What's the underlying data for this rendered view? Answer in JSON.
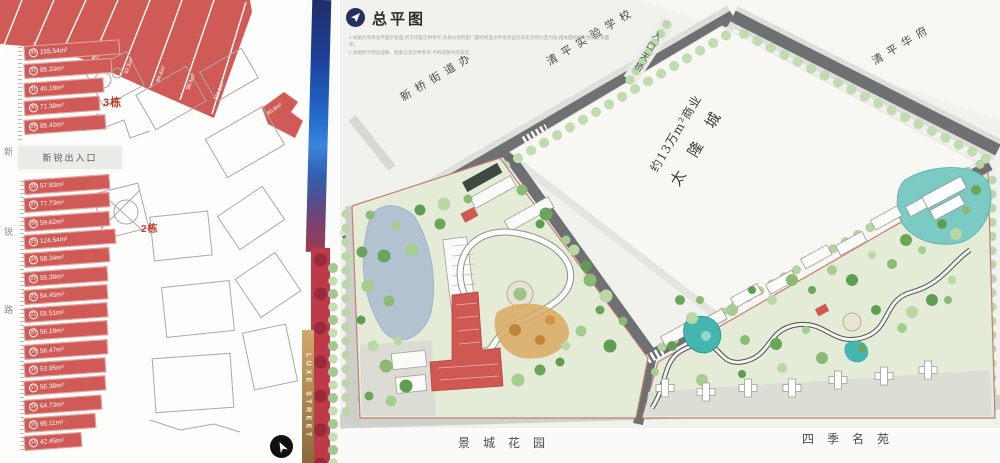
{
  "header": {
    "title": "总平图",
    "disclaimer_line1": "1.本图为项目总平面示意图,所示内容仅供参考,具体以政府部门最终批准文件及商品房买卖合同约定为准;相关面积均为预测建筑面积。",
    "disclaimer_line2": "2.本图所示周边道路、配套信息仅供参考,不构成要约或承诺。"
  },
  "floorplan": {
    "building3_label": "3栋",
    "building2_label": "2栋",
    "entrance_label": "新锐出入口",
    "street_chars": [
      "新",
      "锐",
      "路"
    ],
    "diagonal_units": [
      {
        "no": "1",
        "area": "96.4m²"
      },
      {
        "no": "2",
        "area": "88.3m²"
      },
      {
        "no": "3",
        "area": "85.2m²"
      },
      {
        "no": "4",
        "area": "87.7m²"
      },
      {
        "no": "5",
        "area": "92.5m²"
      },
      {
        "no": "6",
        "area": "84.6m²"
      },
      {
        "no": "7",
        "area": "98.5m²"
      },
      {
        "no": "8",
        "area": "111.1m²"
      }
    ],
    "corner_unit": {
      "no": "9",
      "area": "45.8m²"
    },
    "upper_units": [
      {
        "no": "33",
        "area": "155.54m²"
      },
      {
        "no": "32",
        "area": "85.33m²"
      },
      {
        "no": "31",
        "area": "40.19m²"
      },
      {
        "no": "30",
        "area": "71.38m²"
      },
      {
        "no": "29",
        "area": "85.42m²"
      }
    ],
    "lower_units": [
      {
        "no": "28",
        "area": "57.83m²"
      },
      {
        "no": "27",
        "area": "77.73m²"
      },
      {
        "no": "26",
        "area": "59.62m²"
      },
      {
        "no": "25",
        "area": "124.54m²"
      },
      {
        "no": "24",
        "area": "58.34m²"
      },
      {
        "no": "23",
        "area": "55.38m²"
      },
      {
        "no": "22",
        "area": "54.45m²"
      },
      {
        "no": "21",
        "area": "55.51m²"
      },
      {
        "no": "20",
        "area": "56.19m²"
      },
      {
        "no": "19",
        "area": "56.47m²"
      },
      {
        "no": "18",
        "area": "53.95m²"
      },
      {
        "no": "17",
        "area": "56.38m²"
      },
      {
        "no": "16",
        "area": "64.73m²"
      },
      {
        "no": "15",
        "area": "95.11m²"
      },
      {
        "no": "14",
        "area": "42.45m²"
      }
    ]
  },
  "divider": {
    "luxe_label": "LUXE STREET"
  },
  "map": {
    "school_label": "清平实验学校",
    "street_office_label": "新桥街道办",
    "bridge_label": "入口天桥",
    "huafu_label": "清平华府",
    "commercial_line1": "约13万m²商业",
    "commercial_line2": "太 隆 城",
    "south_left_label": "景城花园",
    "south_right_label": "四季名苑"
  },
  "colors": {
    "unit_red": "#d05a55",
    "accent_red": "#c0392b",
    "road_gray": "#6e7072",
    "parcel_green": "#e4ecd8",
    "water_blue": "#b3c2d1",
    "pool_teal": "#45b5af",
    "gold": "#b08b52",
    "strip_blue": "#1e56c0",
    "strip_red": "#bf3a48"
  }
}
